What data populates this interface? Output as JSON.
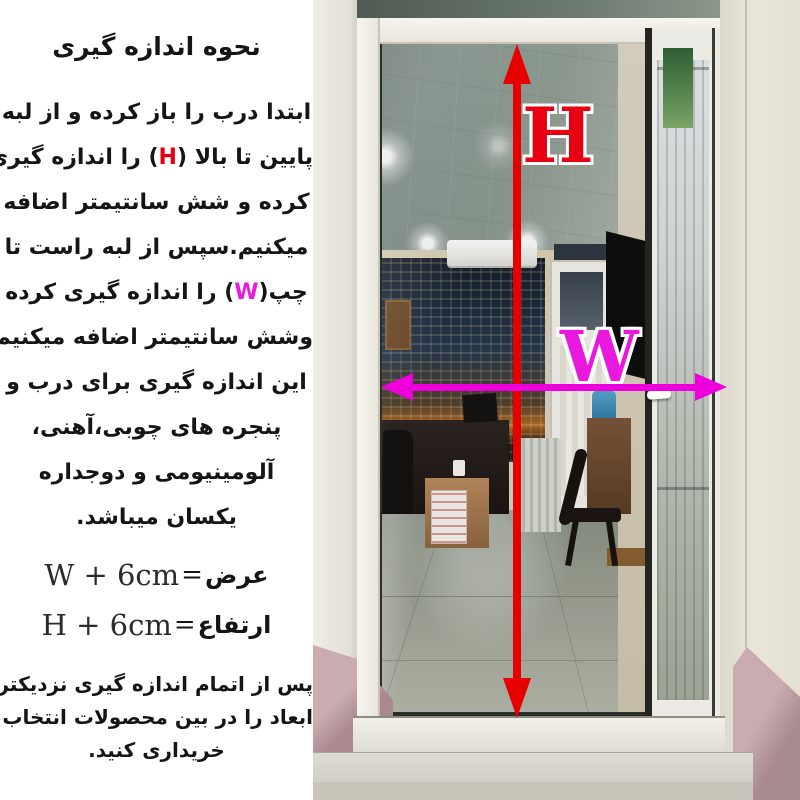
{
  "instructions": {
    "title": "نحوه اندازه گیری",
    "line1": "ابتدا درب را باز کرده و از لبه",
    "line2": {
      "before": "پایین تا بالا ",
      "open": "(",
      "letter": "H",
      "close": ")",
      "after": " را اندازه گیری"
    },
    "line3": "کرده و شش سانتیمتر اضافه",
    "line4": "میکنیم.سپس از لبه راست تا",
    "line5": {
      "before": "چپ",
      "open": "(",
      "letter": "W",
      "close": ")",
      "after": " را اندازه گیری کرده"
    },
    "line6": "وشش سانتیمتر اضافه میکنیم.",
    "line7": "این اندازه گیری برای درب و",
    "line8": "پنجره های چوبی،آهنی،",
    "line9": "آلومینیومی و دوجداره",
    "line10": "یکسان میباشد."
  },
  "formulas": {
    "width": {
      "fa": "عرض",
      "eq": "=",
      "expr": "W + 6cm"
    },
    "height": {
      "fa": "ارتفاع",
      "eq": "=",
      "expr": "H + 6cm"
    }
  },
  "footer": {
    "line1": "پس از اتمام اندازه گیری نزدیکترین",
    "line2": "ابعاد را در بین محصولات انتخاب و",
    "line3": "خریداری کنید."
  },
  "measurement": {
    "height_label": "H",
    "width_label": "W"
  },
  "colors": {
    "height_accent": "#e60011",
    "width_accent": "#e818dc",
    "text": "#151515",
    "background": "#ffffff"
  }
}
